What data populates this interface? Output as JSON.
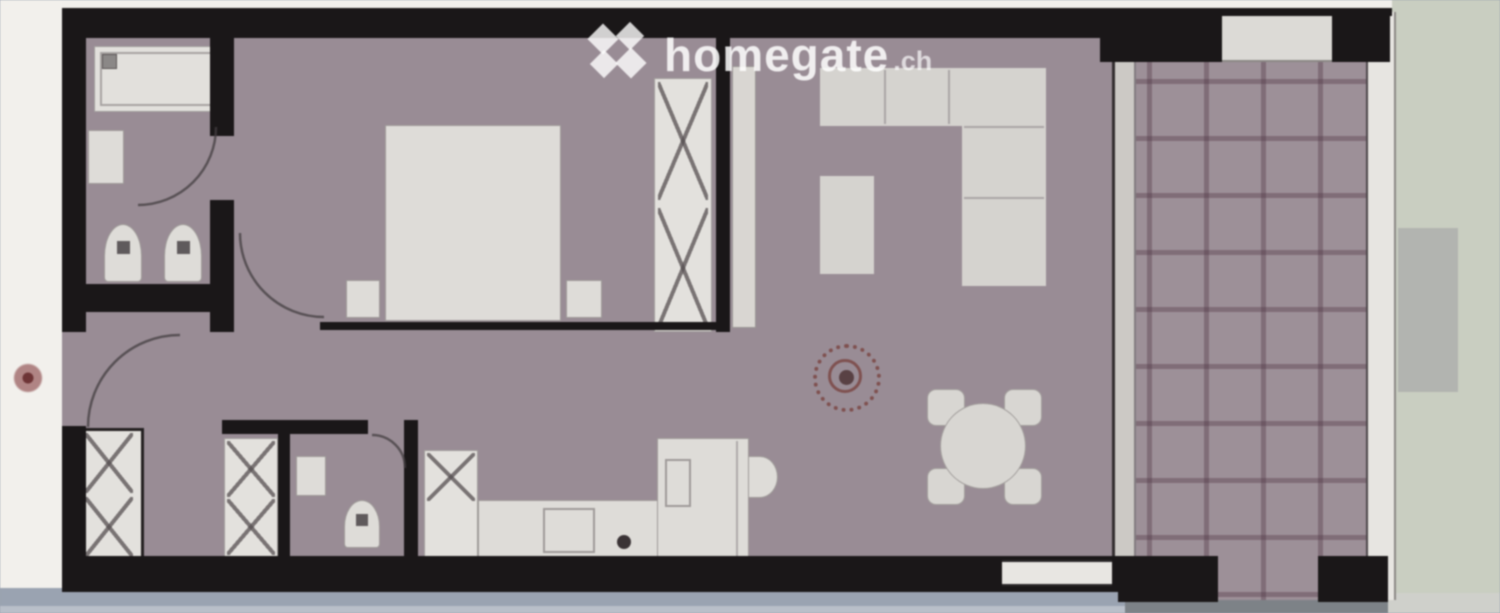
{
  "watermark": {
    "brand": "homegate",
    "tld": ".ch",
    "logo_icon": "homegate-x-logo"
  },
  "palette": {
    "wall_black": "#1a1718",
    "apartment_floor_mauve": "#998c95",
    "terrace_floor_mauve": "#9d9098",
    "terrace_grid_line": "#503544",
    "furniture_white": "#dedcd8",
    "outside_left_white": "#f2f0ec",
    "outside_right_green": "#c9cec1",
    "outside_bottom_bluegrey": "#9aa3b1",
    "stamp_red": "#7b4745",
    "watermark_white": "#ffffff"
  },
  "floorplan": {
    "type": "apartment-floor-plan",
    "rooms": [
      "bathroom",
      "bedroom",
      "hall",
      "wc-reduit",
      "kitchen",
      "living-dining",
      "terrace"
    ],
    "furniture": [
      "bathtub",
      "washbasin",
      "toilet",
      "bidet",
      "double-bed",
      "nightstand-left",
      "nightstand-right",
      "wardrobe",
      "hall-closet",
      "wc-closet",
      "wc-washbasin",
      "wc-toilet",
      "kitchen-tall-cabinet",
      "kitchen-counter",
      "kitchen-sink",
      "kitchen-island",
      "kitchen-basin-bump",
      "corner-sofa",
      "armchair",
      "round-dining-table",
      "dining-chairs",
      "red-stamp-mark"
    ]
  }
}
